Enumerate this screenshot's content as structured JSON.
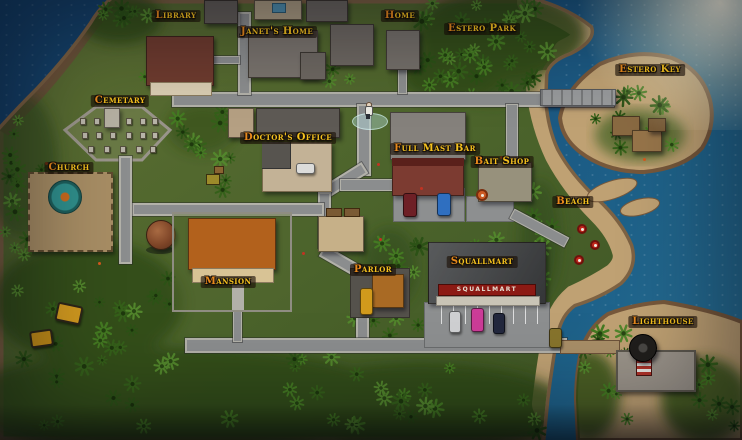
{
  "map": {
    "locations": [
      {
        "label": "Library",
        "x": 176,
        "y": 16
      },
      {
        "label": "Janet's Home",
        "x": 277,
        "y": 32
      },
      {
        "label": "Home",
        "x": 400,
        "y": 16
      },
      {
        "label": "Estero Park",
        "x": 482,
        "y": 29
      },
      {
        "label": "Estero Key",
        "x": 650,
        "y": 70
      },
      {
        "label": "Cemetary",
        "x": 120,
        "y": 101
      },
      {
        "label": "Doctor's Office",
        "x": 288,
        "y": 138
      },
      {
        "label": "Full Mast Bar",
        "x": 435,
        "y": 149
      },
      {
        "label": "Bait Shop",
        "x": 502,
        "y": 162
      },
      {
        "label": "Church",
        "x": 69,
        "y": 168
      },
      {
        "label": "Beach",
        "x": 573,
        "y": 202
      },
      {
        "label": "Mansion",
        "x": 228,
        "y": 282
      },
      {
        "label": "Parlor",
        "x": 373,
        "y": 270
      },
      {
        "label": "Squallmart",
        "x": 482,
        "y": 262
      },
      {
        "label": "Lighthouse",
        "x": 663,
        "y": 322
      }
    ],
    "storefront_sign": "SQUALLMART",
    "colors": {
      "label_text": "#f5c21e",
      "label_bg": "rgba(26,15,5,0.62)",
      "water": "#1a4e7a",
      "grass": "#55682e",
      "sand": "#bfa173",
      "road": "#8b8d8e",
      "squallmart_banner": "#8c1a14"
    }
  }
}
